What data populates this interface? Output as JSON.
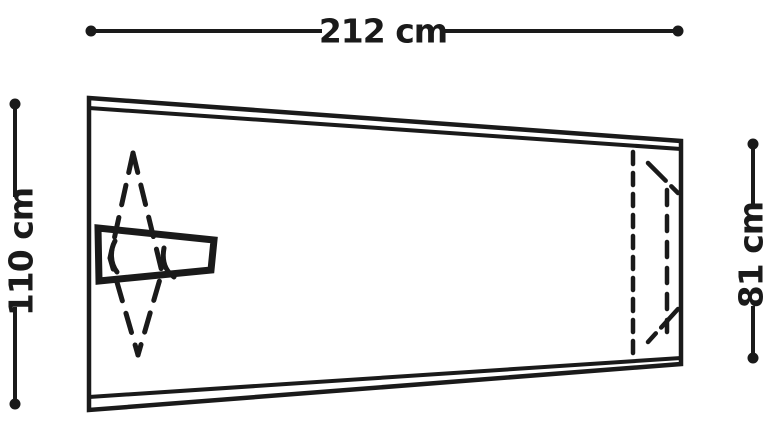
{
  "diagram": {
    "labels": {
      "width": "212 cm",
      "height_left": "110 cm",
      "height_right": "81 cm"
    },
    "colors": {
      "panel_fill": "#dcdcdc",
      "line": "#1a1a1a",
      "background": "#ffffff"
    }
  }
}
